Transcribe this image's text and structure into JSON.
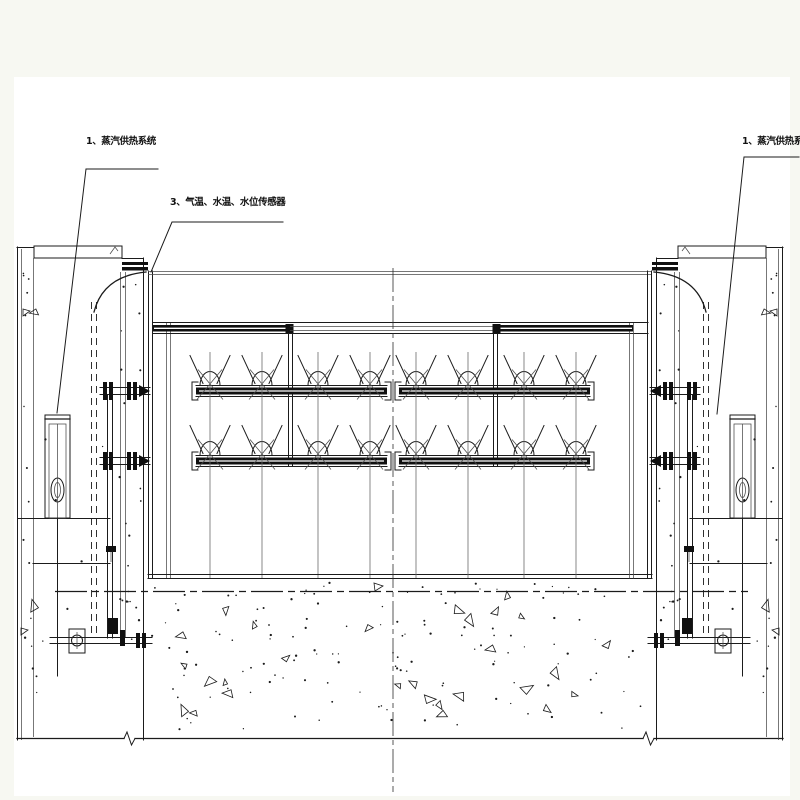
{
  "page": {
    "background": "#f7f8f2",
    "sheet": "#ffffff",
    "ink": "#1b1b1b"
  },
  "callouts": [
    {
      "text": "1、蒸汽供热系统"
    },
    {
      "text": "3、气温、水温、水位传感器"
    },
    {
      "text": "1、蒸汽供热系统"
    }
  ]
}
